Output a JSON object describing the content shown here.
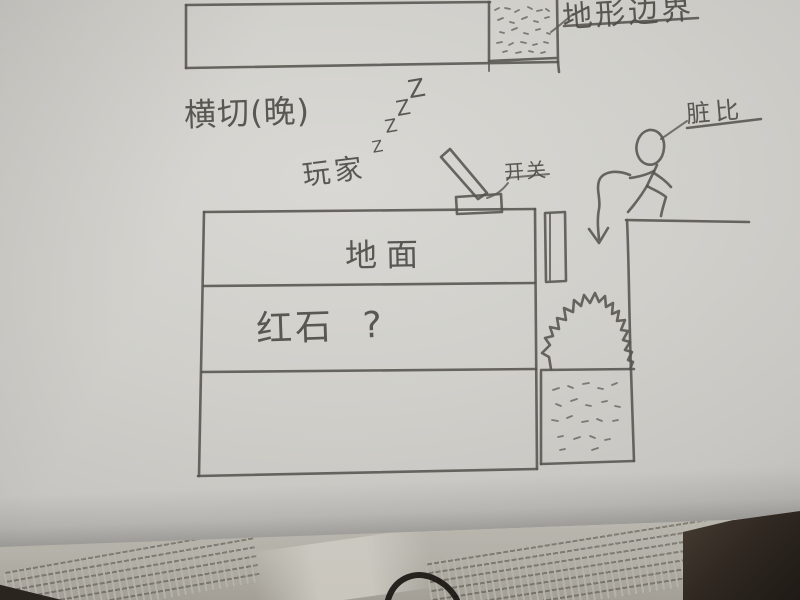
{
  "labels": {
    "terrain": "地形边界",
    "cross_section": "横切(晚)",
    "player": "玩家",
    "snores": [
      "Z",
      "Z",
      "Z",
      "Z"
    ],
    "switch": "开关",
    "figure": "脏比",
    "ground": "地面",
    "redstone": "红石 ?"
  },
  "colors": {
    "pencil": "#56544e",
    "paper": "#d0cfca",
    "book_page": "#b4b1a9",
    "desk": "#2e2720",
    "cable_ink": "#16120e"
  }
}
